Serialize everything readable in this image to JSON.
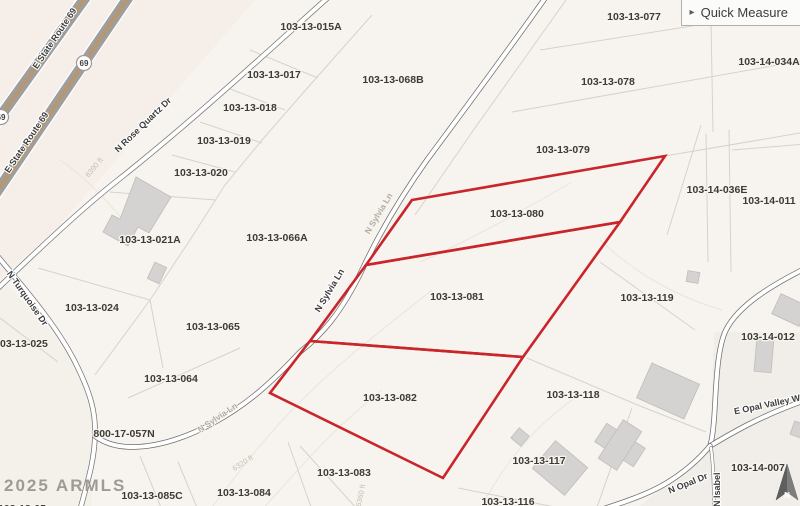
{
  "button": {
    "icon": "▸",
    "label": "Quick Measure"
  },
  "watermark": "2025 ARMLS",
  "compass": {
    "north": "N"
  },
  "highway": {
    "name": "E State Route 69",
    "shield": "69"
  },
  "streets": {
    "rose_quartz": "N Rose Quartz Dr",
    "turquoise": "N Turquoise Dr",
    "sylvia": "N Sylvia Ln",
    "opal_valley": "E Opal Valley Wa",
    "opal_dr": "N Opal Dr",
    "isabella": "N Isabel"
  },
  "contour_labels": [
    "6390 ft",
    "6320 ft",
    "6360 ft"
  ],
  "selected_parcels": [
    "103-13-080",
    "103-13-081",
    "103-13-082"
  ],
  "colors": {
    "selection_outline": "#c9252b",
    "highway_stripe": "#d2903e",
    "road_casing": "#6e6e6e",
    "building_fill": "#d4d3d1"
  },
  "parcels": [
    "103-13-015A",
    "103-13-017",
    "103-13-018",
    "103-13-019",
    "103-13-020",
    "103-13-021A",
    "103-13-066A",
    "103-13-068B",
    "103-13-024",
    "103-13-025",
    "103-13-065",
    "103-13-064",
    "800-17-057N",
    "103-13-085C",
    "103-13-084",
    "103-13-083",
    "103-13-082",
    "103-13-081",
    "103-13-080",
    "103-13-079",
    "103-13-077",
    "103-13-078",
    "103-14-034A",
    "103-14-036E",
    "103-14-011",
    "103-13-119",
    "103-14-012",
    "103-13-118",
    "103-13-117",
    "103-13-116",
    "103-14-007",
    "103-13-05"
  ]
}
